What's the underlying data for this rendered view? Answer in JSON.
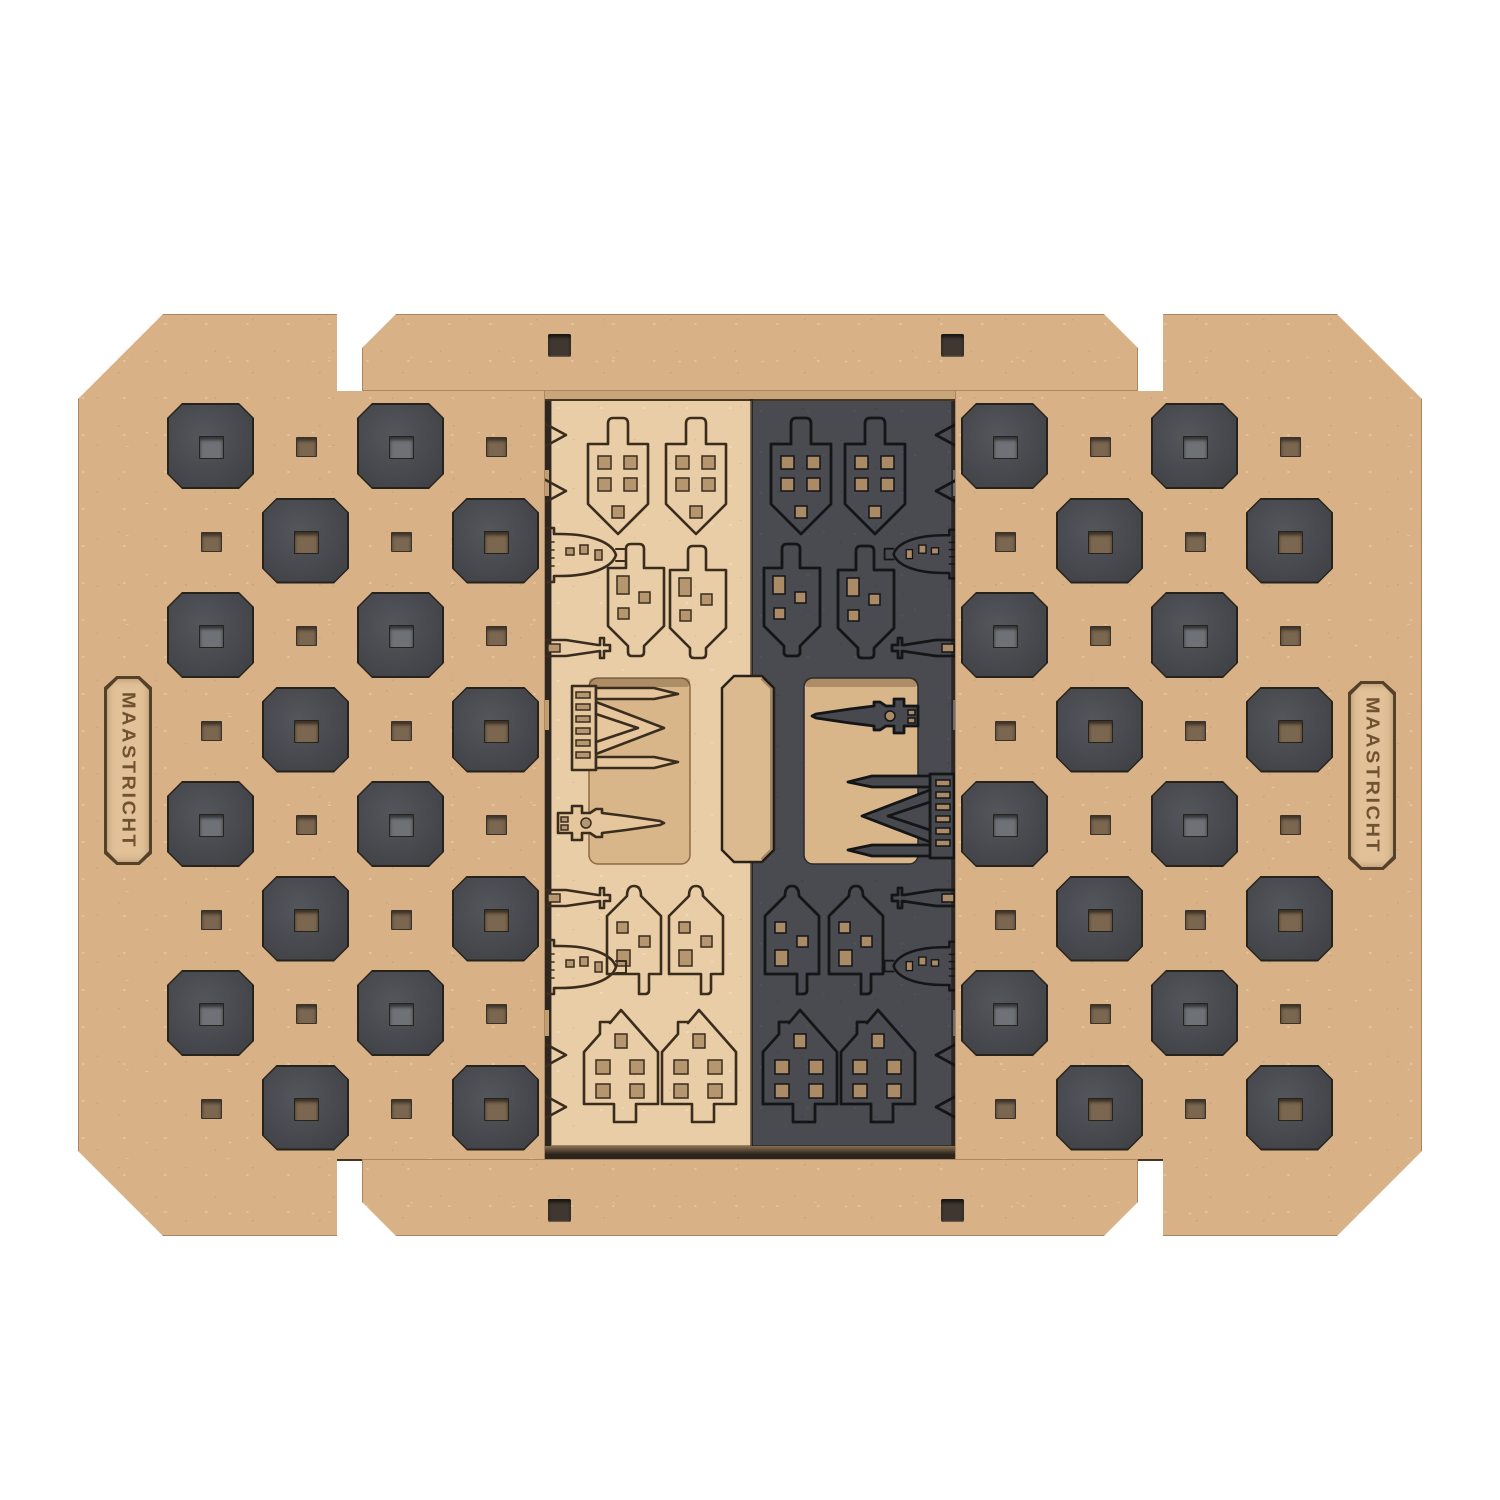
{
  "image_type": "product-photo",
  "subject": "Flat-lay top view of a laser-cut MDF travel chess set with building-shaped pieces",
  "background_color": "#ffffff",
  "branding": {
    "left_plaque_text": "MAASTRICHT",
    "right_plaque_text": "MAASTRICHT"
  },
  "board": {
    "halves": 2,
    "rows": 8,
    "cols_per_half": 4,
    "cell_px": 95,
    "dark_cell_color": "#47494e",
    "base_wood_color": "#d8b286",
    "peg_hole_shape": "square"
  },
  "sheets": {
    "light": {
      "wood_color": "#e9cda6",
      "engraving_color": "#3a2d1e",
      "pieces_visible": [
        "pawn-house x8",
        "dome-church x2",
        "spire-with-cross x2",
        "cathedral x1",
        "clock-tower x1",
        "spire-tip x4"
      ]
    },
    "dark": {
      "wood_color": "#494b50",
      "engraving_color": "#141517",
      "pieces_visible": [
        "pawn-house x8",
        "dome-church x2",
        "spire-with-cross x2",
        "cathedral x1",
        "clock-tower x1",
        "spire-tip x4"
      ]
    }
  },
  "hardware": {
    "top_bar_slots": 2,
    "bottom_bar_slots": 2,
    "handle_cutouts": 1
  },
  "colors": {
    "bar_wood": "#dcb98d",
    "tray_recess": "#d9b68a",
    "handle_fill": "#dcba90",
    "slot_color": "#3f3730"
  }
}
